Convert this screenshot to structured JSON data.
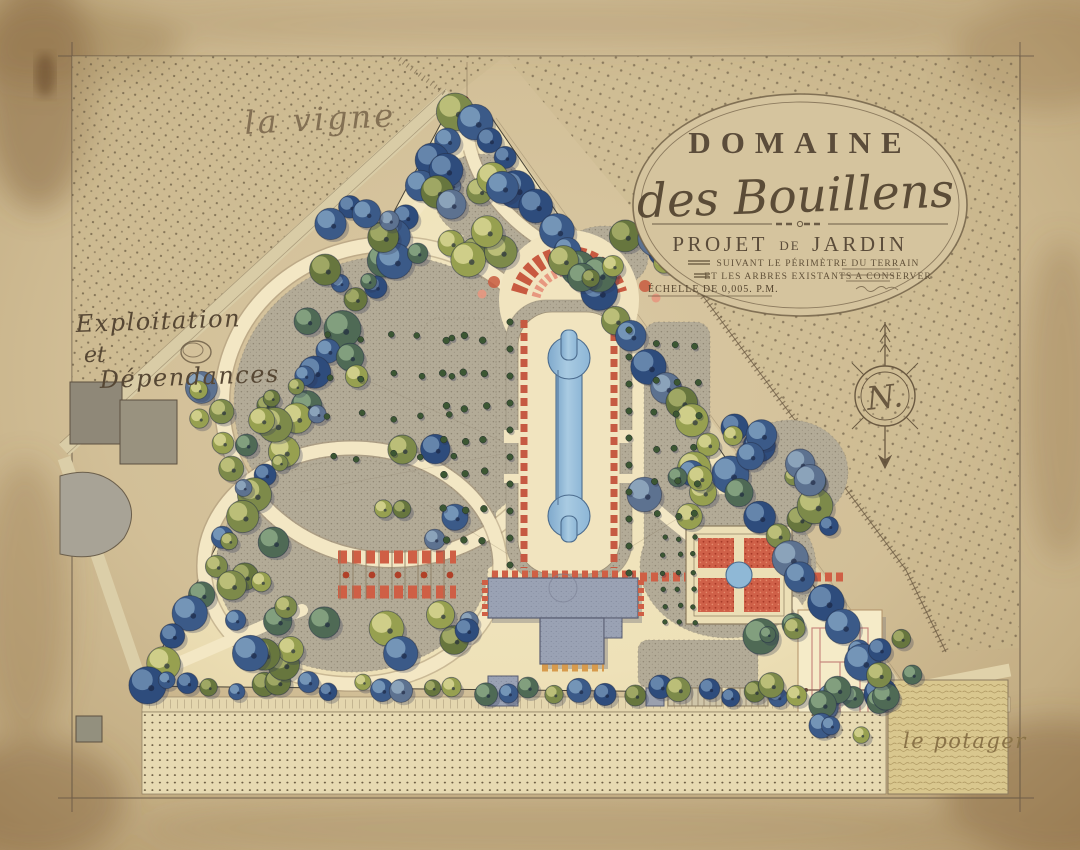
{
  "plan": {
    "area_labels": {
      "vineyard": "la vigne",
      "estate_line1": "Exploitation",
      "estate_line2": "et",
      "estate_line3": "Dépendances",
      "kitchen_garden": "le potager"
    },
    "cartouche": {
      "domain_word": "DOMAINE",
      "name_script": "des Bouillens",
      "project_word1": "PROJET",
      "project_word2": "DE",
      "project_word3": "JARDIN",
      "subtitle_line1": "SUIVANT LE PÉRIMÈTRE DU TERRAIN",
      "subtitle_line2": "ET LES ARBRES EXISTANTS A CONSERVER",
      "scale_note": "ÉCHELLE DE 0,005. P.M."
    },
    "compass_letter": "N.",
    "colors": {
      "paper": "#cdb990",
      "garden_cream": "#efe2bb",
      "lawn_grey": "#b2aa96",
      "water_blue": "#9cc2dc",
      "flower_red": "#c95c42",
      "building_grey": "#9aa2b4",
      "tree_blue": "#2e4c7c",
      "tree_olive": "#67763e",
      "ink": "#5a4a36"
    }
  }
}
